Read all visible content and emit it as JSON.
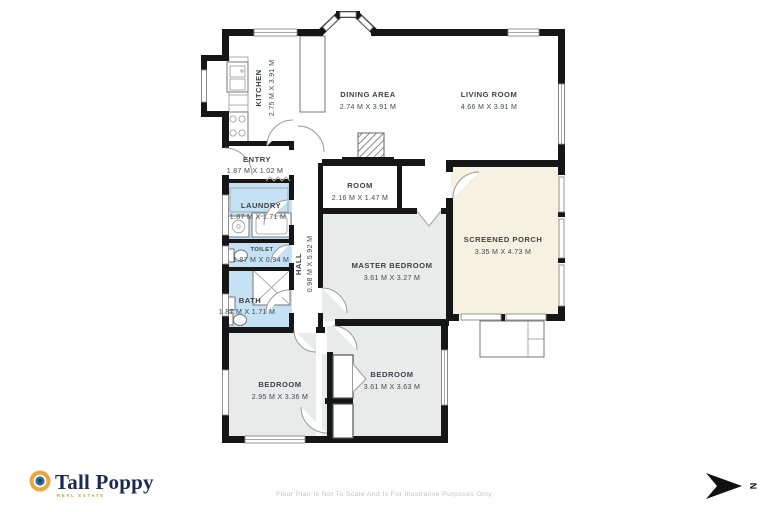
{
  "plan": {
    "rooms": [
      {
        "name": "KITCHEN",
        "dims": "2.75 M X 3.91 M"
      },
      {
        "name": "DINING AREA",
        "dims": "2.74 M X 3.91 M"
      },
      {
        "name": "LIVING ROOM",
        "dims": "4.66 M X 3.91 M"
      },
      {
        "name": "ENTRY",
        "dims": "1.87 M X 1.02 M"
      },
      {
        "name": "ROOM",
        "dims": "2.16 M X 1.47 M"
      },
      {
        "name": "LAUNDRY",
        "dims": "1.87 M X 1.71 M"
      },
      {
        "name": "TOILET",
        "dims": "1.87 M X 0.94 M"
      },
      {
        "name": "HALL",
        "dims": "0.98 M X 5.92 M"
      },
      {
        "name": "MASTER BEDROOM",
        "dims": "3.61 M X 3.27 M"
      },
      {
        "name": "SCREENED PORCH",
        "dims": "3.35 M X 4.73 M"
      },
      {
        "name": "BATH",
        "dims": "1.87 M X 1.71 M"
      },
      {
        "name": "BEDROOM",
        "dims": "2.95 M X 3.36 M"
      },
      {
        "name": "BEDROOM",
        "dims": "3.61 M X 3.63 M"
      }
    ],
    "colors": {
      "wet_room": "#c5e2f4",
      "bedroom": "#e9eaea",
      "porch": "#f7f1e1",
      "wall": "#161616"
    }
  },
  "branding": {
    "logo_text": "Tall Poppy",
    "logo_subtext": "REAL ESTATE",
    "logo_navy": "#1c2a52",
    "logo_ring": "#eda63e",
    "logo_center": "#2d7095"
  },
  "compass": {
    "label": "N"
  },
  "footer": {
    "disclaimer": "Floor Plan Is Not To Scale And Is For Illustrative Purposes Only"
  }
}
